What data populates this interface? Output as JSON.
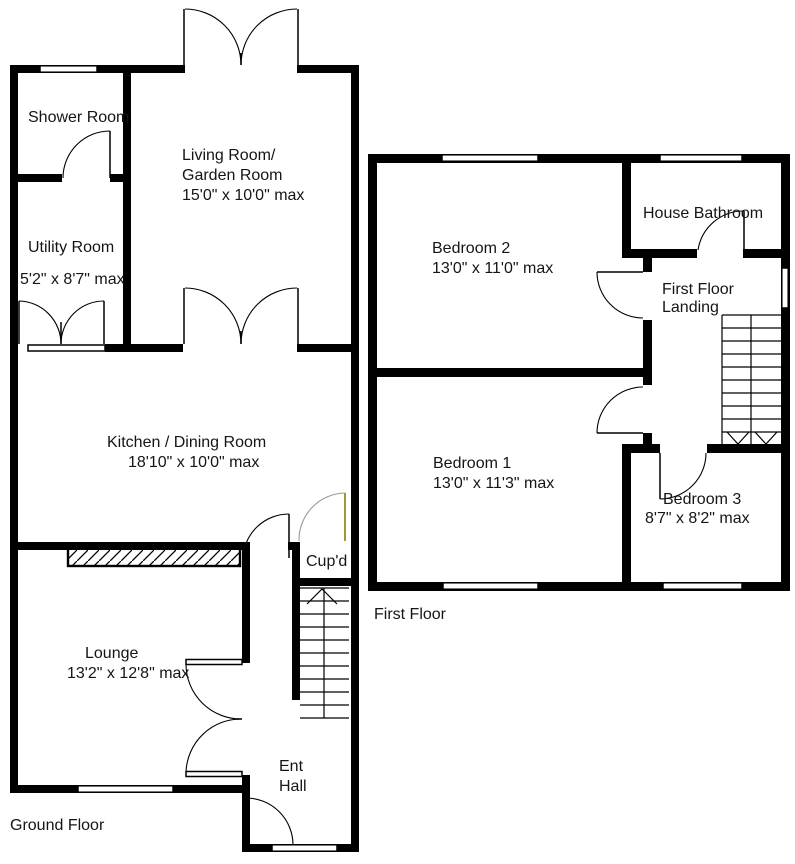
{
  "document_type": "residential floorplan",
  "floors": [
    {
      "caption": "Ground Floor",
      "rooms": [
        {
          "name": "Shower Room"
        },
        {
          "name": "Utility Room",
          "dims": "5'2\" x 8'7\" max"
        },
        {
          "name": "Living Room/",
          "name2": "Garden Room",
          "dims": "15'0\" x 10'0\" max"
        },
        {
          "name": "Kitchen / Dining Room",
          "dims": "18'10\" x 10'0\" max"
        },
        {
          "name": "Lounge",
          "dims": "13'2\" x 12'8\" max"
        },
        {
          "name": "Cup'd"
        },
        {
          "name": "Ent",
          "name2": "Hall"
        }
      ],
      "features": [
        "staircase-up",
        "french-doors-to-garden",
        "front-entrance-door",
        "hatched-worktop-strip"
      ]
    },
    {
      "caption": "First Floor",
      "rooms": [
        {
          "name": "Bedroom 2",
          "dims": "13'0\" x 11'0\" max"
        },
        {
          "name": "House Bathroom"
        },
        {
          "name": "First Floor",
          "name2": "Landing"
        },
        {
          "name": "Bedroom 1",
          "dims": "13'0\" x 11'3\" max"
        },
        {
          "name": "Bedroom 3",
          "dims": "8'7\" x 8'2\" max"
        }
      ],
      "features": [
        "staircase-down",
        "landing-window"
      ]
    }
  ],
  "colors": {
    "background": "#ffffff",
    "walls": "#000000",
    "text": "#151515",
    "cupboard_door_leaf": "#808000",
    "cupboard_door_arc": "#9a9a9a"
  }
}
